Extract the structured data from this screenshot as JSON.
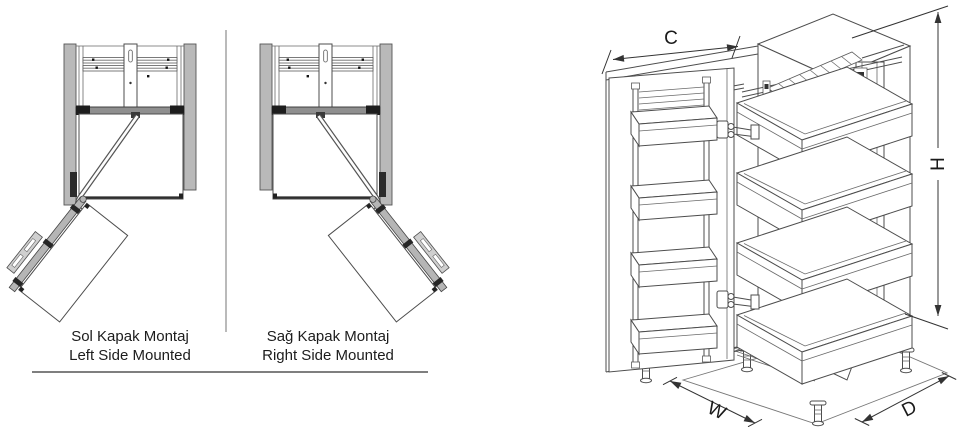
{
  "captions": {
    "left_mount": {
      "line1": "Sol Kapak Montaj",
      "line2": "Left Side Mounted"
    },
    "right_mount": {
      "line1": "Sağ Kapak Montaj",
      "line2": "Right Side Mounted"
    }
  },
  "iso_dimensions": {
    "cabinet_width": "C",
    "cabinet_height": "H",
    "unit_width": "W",
    "unit_depth": "D"
  },
  "colors": {
    "line": "#4d4d4d",
    "metal_gray": "#b5b5b5",
    "dark_metal": "#1f1f1f",
    "dim_text": "#1a1a1a",
    "background": "#ffffff"
  }
}
